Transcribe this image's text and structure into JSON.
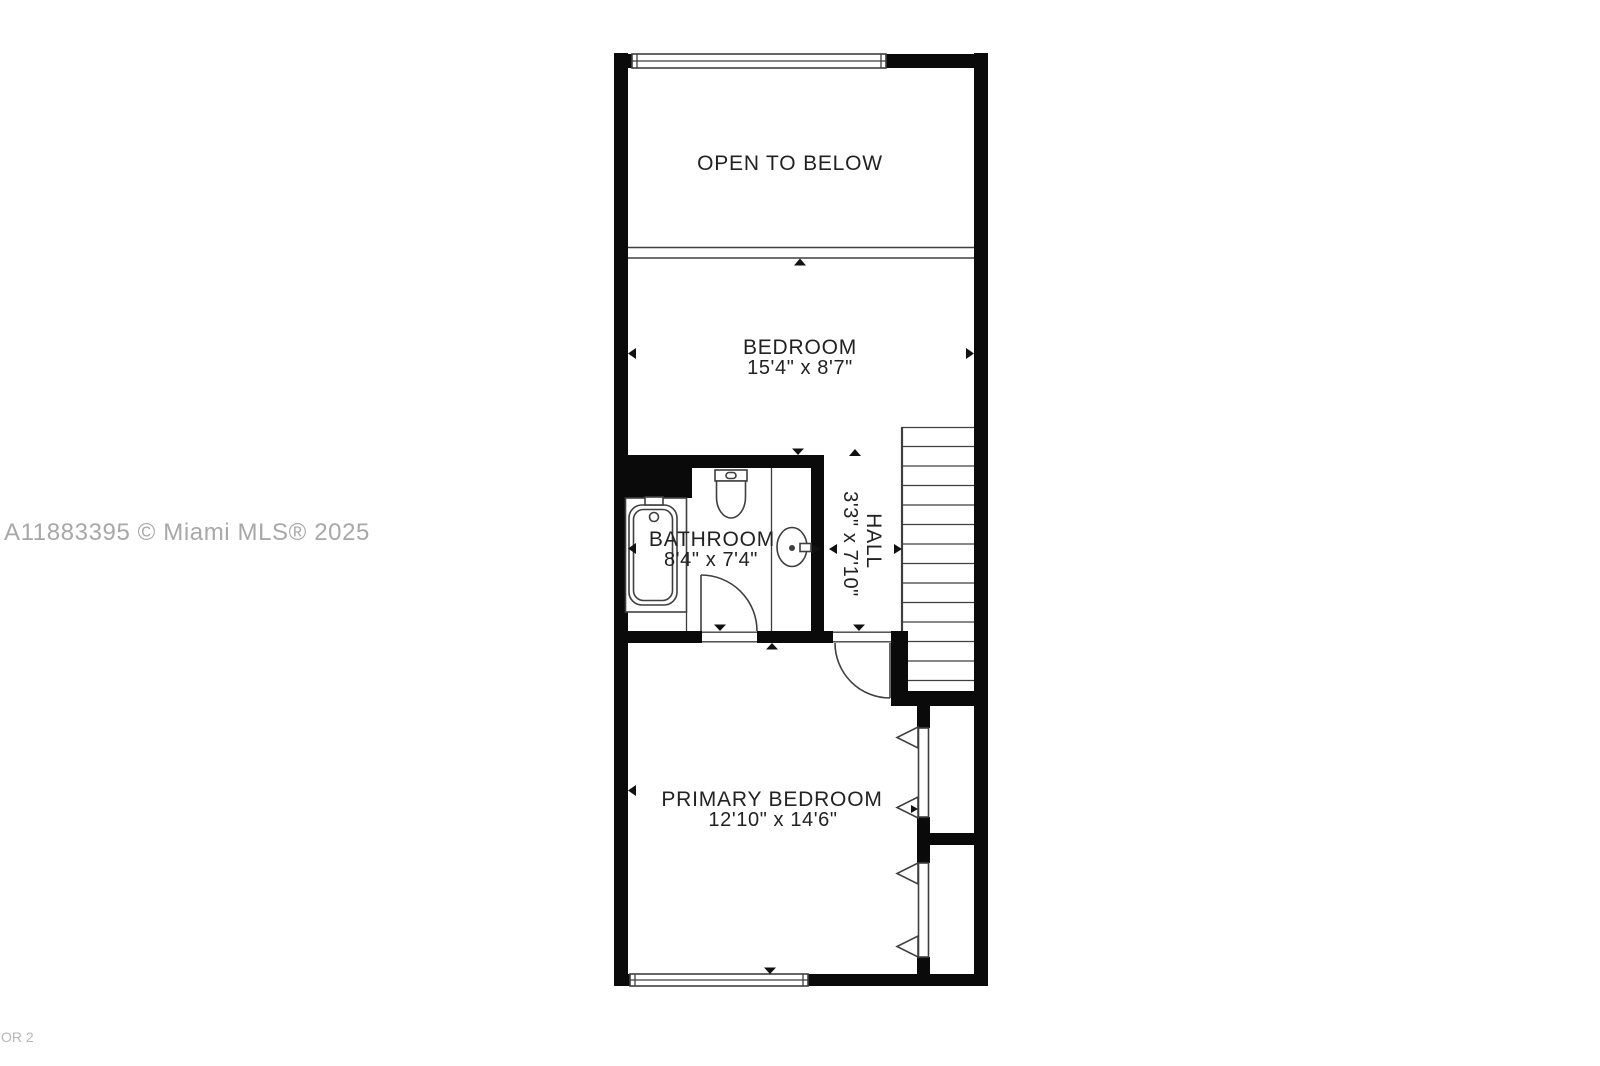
{
  "watermark": {
    "text": "A11883395 © Miami MLS® 2025"
  },
  "footer": {
    "text": "OR 2"
  },
  "rooms": {
    "open_to_below": {
      "label": "OPEN TO BELOW"
    },
    "bedroom": {
      "label": "BEDROOM",
      "dimensions": "15'4\" x 8'7\""
    },
    "bathroom": {
      "label": "BATHROOM",
      "dimensions": "8'4\" x 7'4\""
    },
    "hall": {
      "label": "HALL",
      "dimensions": "3'3\" x 7'10\""
    },
    "primary_bedroom": {
      "label": "PRIMARY BEDROOM",
      "dimensions": "12'10\" x 14'6\""
    }
  },
  "colors": {
    "wall": "#0a0a0a",
    "line": "#3f3f3f",
    "text": "#222222",
    "arrow": "#111111",
    "watermark": "#a8a8a8",
    "footer": "#b6b6b6",
    "bg": "#ffffff"
  }
}
